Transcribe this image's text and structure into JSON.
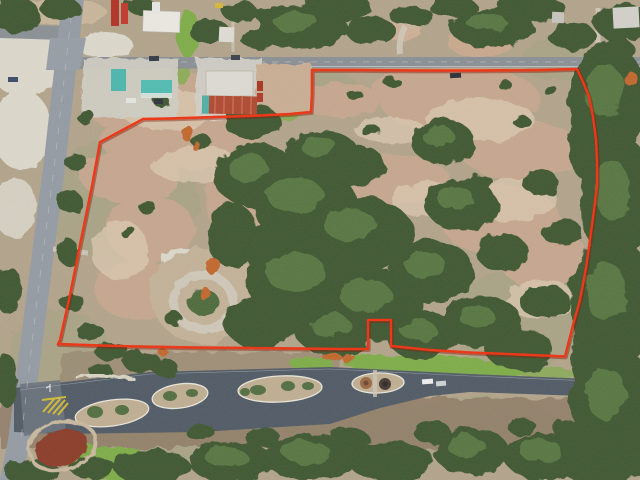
{
  "meta": {
    "type": "aerial-photograph",
    "description": "Drone aerial view of a wooded scrubland parcel outlined in red. A two-lane highway runs down the left side, a commercial corner with teal- and red-roofed buildings sits at top-left, a cross street spans the top, and a divided parkway with landscaped oval medians and an entry monument runs along the bottom.",
    "visible_text": ""
  },
  "boundary": {
    "color": "#ee3312",
    "shadow_color": "rgba(130,25,5,0.45)",
    "stroke_width": "2.4",
    "shadow_width": "4",
    "points": "577,69 540,70 480,70.5 420,70.5 360,70 312,70 312,93 311,112 290,114 260,115.5 230,116.5 200,117.5 170,118.5 143,119 100,142 92,186 81,240 70,295 60,340 58,344 100,345.5 140,346.5 195,347.5 250,348 300,348.5 340,349 368,349 368,320 391,320 391,346 430,350 470,352.5 520,354.5 565,356.5 573,325 580,300 586,268 590,240 594,210 597,185 597,162 596,140 593,117 589,97 583,82"
  },
  "palette": {
    "ground_base": "#b3a48b",
    "scrub_olive": "#a3a382",
    "field_pink": "#c6a78f",
    "field_light": "#dcc9b1",
    "bottom_scrub": "#8f7d66",
    "tree_dark": "#405832",
    "tree_mid": "#4f6c3e",
    "tree_light": "#648549",
    "autumn_orange": "#c2672f",
    "grass_green": "#7fad4a",
    "road_main": "#959ba4",
    "road_top": "#8b9095",
    "road_parkway": "#515b66",
    "concrete": "#cfccc2",
    "caliche_white": "#dcd8cb",
    "gravel": "#cfc8b9",
    "island_tan": "#bfae92",
    "curb_white": "#e9e5da",
    "roof_teal": "#4db7ad",
    "roof_red": "#b04a31",
    "roof_white": "#eae8e1",
    "truck_red": "#b23227",
    "marking_yellow": "#d9c033",
    "mulch_red": "#8c3e2b",
    "monument_brown": "#9c6a44",
    "monument_dark": "#463a34"
  },
  "features": {
    "highway": "two-lane highway, left edge",
    "cross_street": "cross street along top",
    "side_street": "side street, top left",
    "gas_station": "teal canopy gas station",
    "red_roof_building": "red corrugated-roof commercial building",
    "white_building": "white flat-roof commercial building",
    "parkway": "divided parkway with oval medians",
    "entry_monument": "landscaped entry monument island",
    "gravel_loop": "gravel loop driveway inside parcel",
    "notch": "small rectangular exclusion on bottom boundary",
    "chevrons": "yellow gore striping at parkway junction"
  }
}
